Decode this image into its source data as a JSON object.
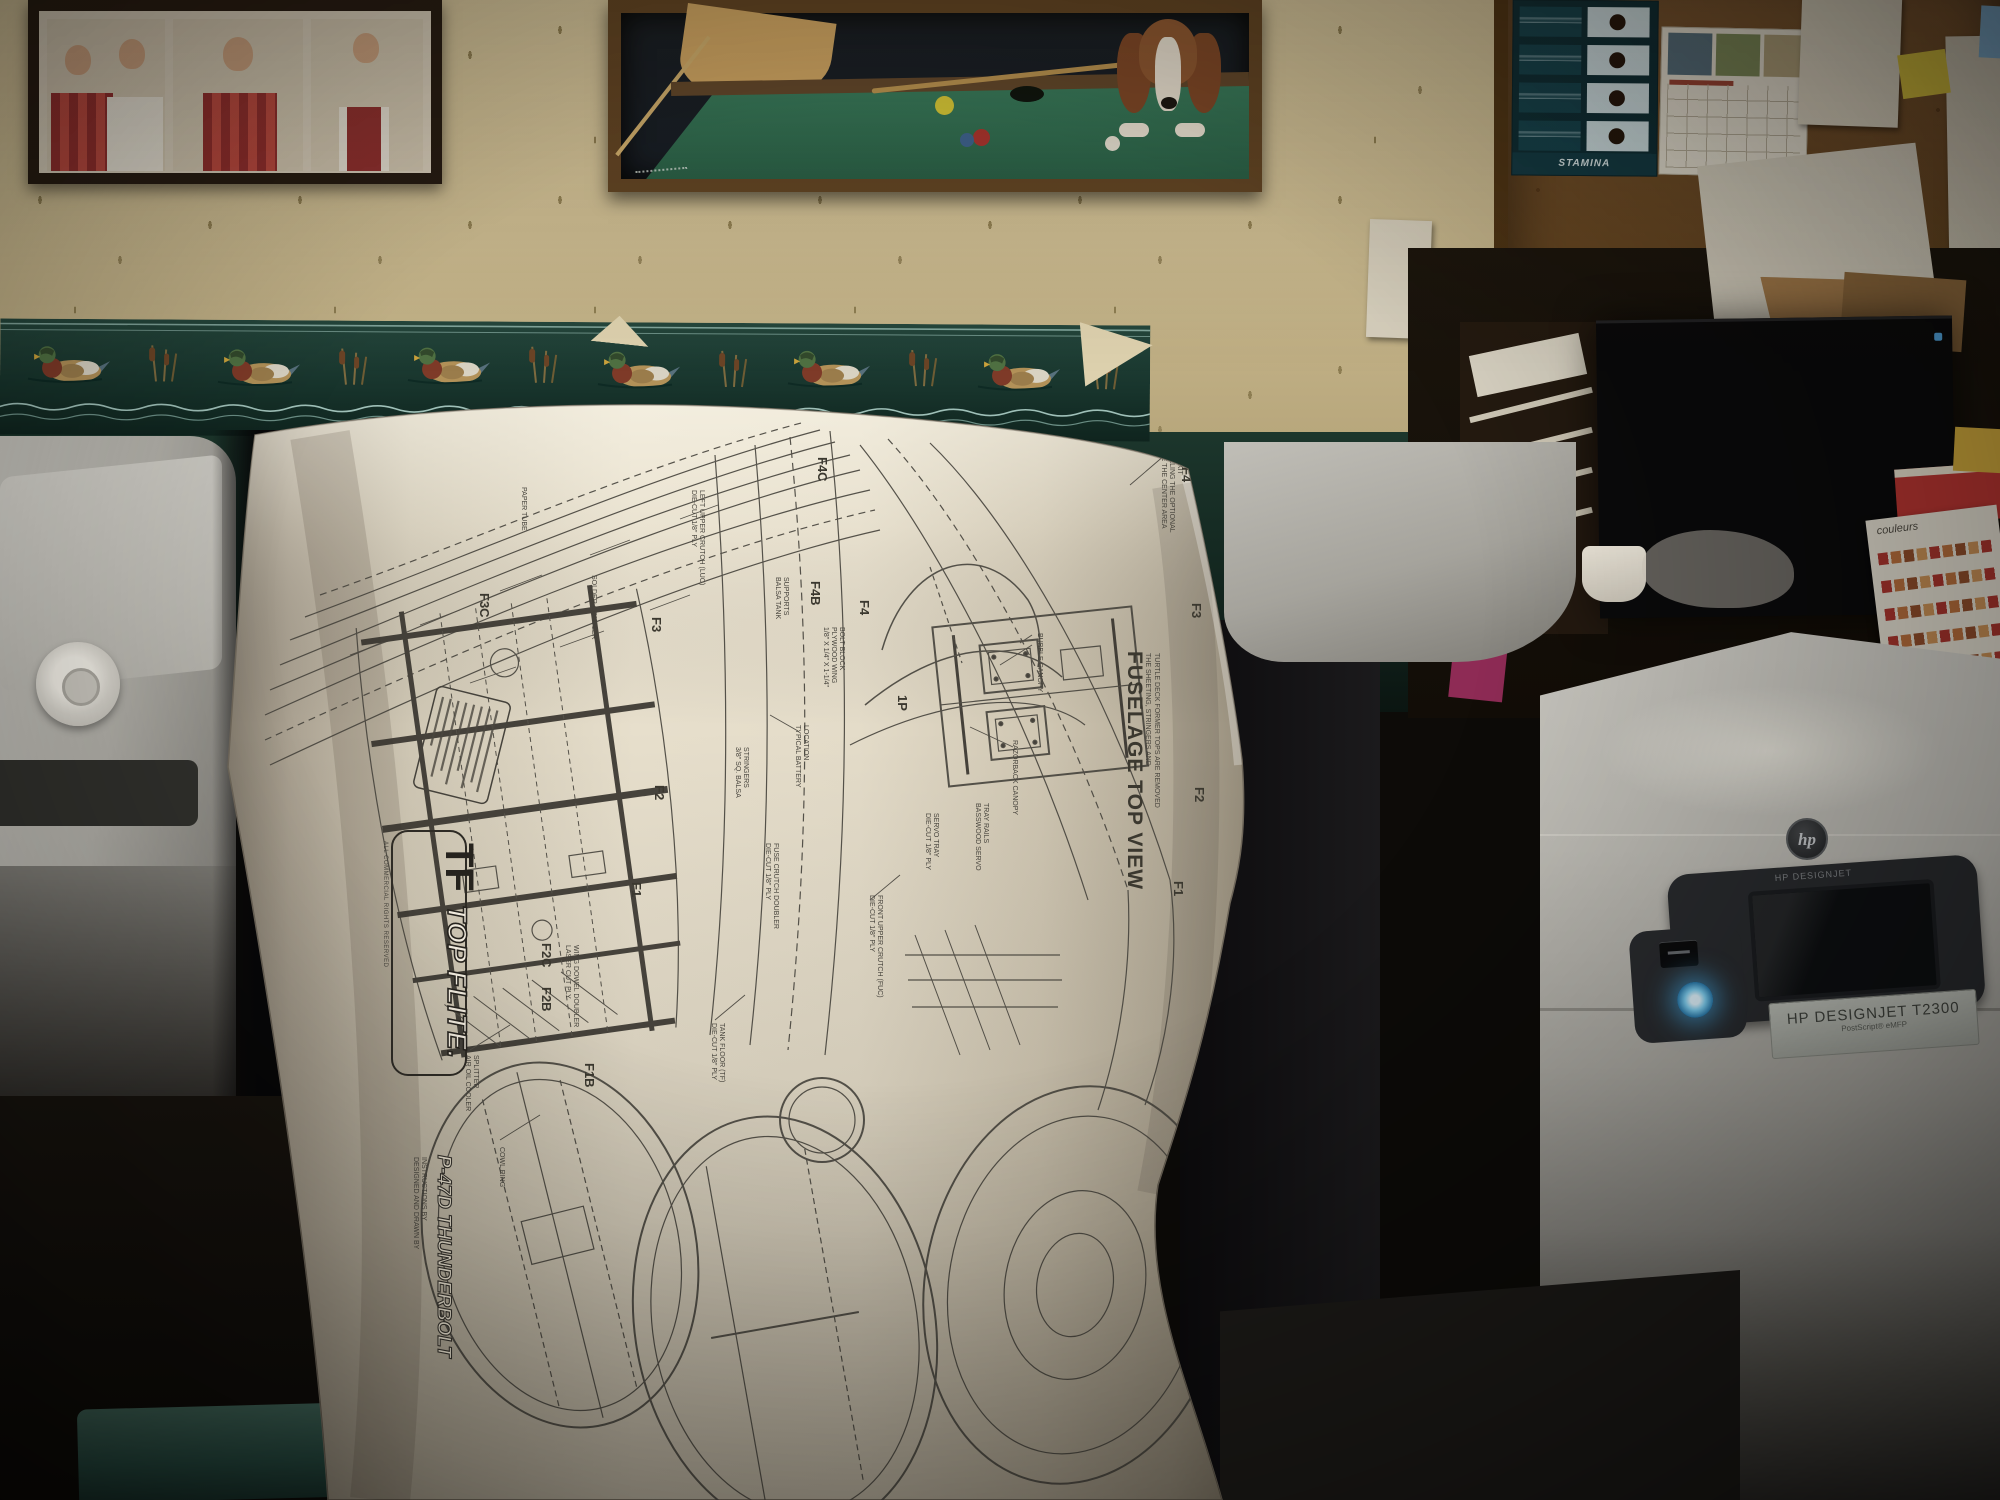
{
  "plan": {
    "title": "FUSELAGE TOP VIEW",
    "subtitle1": "THE SHEETING, STRINGERS AND",
    "subtitle2": "TURTLE DECK FORMER TOPS ARE REMOVED",
    "brand_monogram": "TF",
    "brand_name": "TOP FLITE.",
    "brand_rights": "ALL COMMERCIAL RIGHTS RESERVED",
    "model_name": "P-47D THUNDERBOLT",
    "model_credit1": "DESIGNED AND DRAWN BY",
    "model_credit2": "INSTRUCTIONS BY",
    "formers": {
      "f4c": "F4C",
      "f4b": "F4B",
      "f4": "F4",
      "f3c": "F3C",
      "f3": "F3",
      "f2c": "F2C",
      "f2b": "F2B",
      "f2": "F2",
      "f1b": "F1B",
      "f1": "F1",
      "p1": "1P",
      "f4r": "F4",
      "f3r": "F3",
      "f2r": "F2",
      "f1r": "F1"
    },
    "callouts": {
      "bubble": "BUBBLE CANOPY",
      "razorback": "RAZORBACK CANOPY",
      "paper_tube": "PAPER TUBE",
      "coupler": "SOLDER COUPLER",
      "remove1": "REMOVE THE CENTER AREA",
      "remove2": "IF INSTALLING THE OPTIONAL",
      "remove3": "COCKPIT KIT",
      "servo_rails1": "BASSWOOD SERVO",
      "servo_rails2": "TRAY RAILS",
      "servo_tray1": "DIE-CUT 1/8\" PLY",
      "servo_tray2": "SERVO TRAY",
      "luc1": "DIE-CUT 1/8\" PLY",
      "luc2": "LEFT UPPER CRUTCH (LUC)",
      "fuc1": "DIE-CUT 1/8\" PLY",
      "fuc2": "FRONT UPPER CRUTCH (FUC)",
      "tank_floor1": "DIE-CUT 1/8\" PLY",
      "tank_floor2": "TANK FLOOR (TF)",
      "doubler1": "DIE-CUT 1/8\" PLY",
      "doubler2": "FUSE CRUTCH DOUBLER",
      "dowel1": "LASER CUT PLY",
      "dowel2": "WING DOWEL DOUBLER",
      "splitter1": "AIR OIL COOLER",
      "splitter2": "SPLITTER",
      "cowl_ring": "COWL RING",
      "battery1": "TYPICAL BATTERY",
      "battery2": "LOCATION",
      "tank_sup1": "BALSA TANK",
      "tank_sup2": "SUPPORTS",
      "bolt1": "1/8\" X 1/4\" X 1-1/4\"",
      "bolt2": "PLYWOOD WING",
      "bolt3": "BOLT BLOCK",
      "stringers1": "3/8\" SQ. BALSA",
      "stringers2": "STRINGERS"
    }
  },
  "printer": {
    "brand_small": "HP DESIGNJET",
    "model_label": "HP DESIGNJET T2300",
    "model_sub": "PostScript® eMFP",
    "logo_text": "hp",
    "power_led_color": "#57b8ec"
  },
  "corkboard": {
    "poster_brand": "STAMINA"
  },
  "desk": {
    "chart_text": "couleurs"
  },
  "palette": {
    "wall_green": "#16362c",
    "wallpaper": "#cbbb92",
    "plan_paper": "#e9e2d0",
    "plan_ink": "#45423b",
    "printer_body": "#c6c4bd",
    "carpet": "#a78e66",
    "cork": "#6f4b26"
  }
}
